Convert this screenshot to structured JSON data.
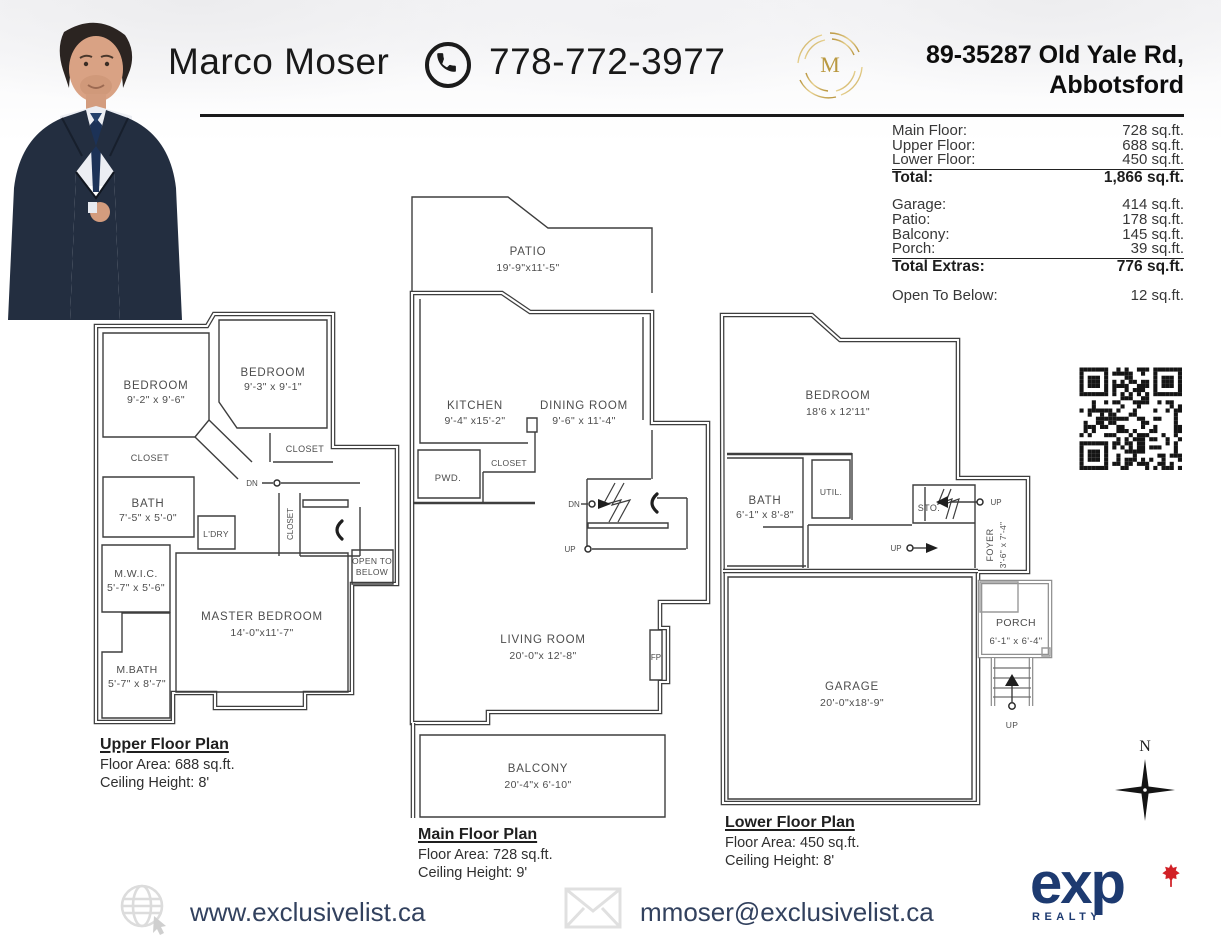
{
  "header": {
    "agent_name": "Marco Moser",
    "phone": "778-772-3977",
    "address_line1": "89-35287 Old Yale Rd,",
    "address_line2": "Abbotsford"
  },
  "area_table": {
    "floor_rows": [
      {
        "label": "Main Floor:",
        "value": "728 sq.ft."
      },
      {
        "label": "Upper Floor:",
        "value": "688 sq.ft."
      },
      {
        "label": "Lower Floor:",
        "value": "450 sq.ft."
      }
    ],
    "total": {
      "label": "Total:",
      "value": "1,866 sq.ft."
    },
    "extra_rows": [
      {
        "label": "Garage:",
        "value": "414 sq.ft."
      },
      {
        "label": "Patio:",
        "value": "178 sq.ft."
      },
      {
        "label": "Balcony:",
        "value": "145 sq.ft."
      },
      {
        "label": "Porch:",
        "value": "39 sq.ft."
      }
    ],
    "total_extras": {
      "label": "Total Extras:",
      "value": "776 sq.ft."
    },
    "open_to_below": {
      "label": "Open To Below:",
      "value": "12 sq.ft."
    }
  },
  "plans": {
    "upper": {
      "title": "Upper Floor Plan",
      "area": "Floor Area: 688 sq.ft.",
      "ceiling": "Ceiling Height: 8'",
      "rooms": {
        "bedroom_left": {
          "name": "BEDROOM",
          "dims": "9'-2\" x 9'-6\""
        },
        "bedroom_right": {
          "name": "BEDROOM",
          "dims": "9'-3\" x 9'-1\""
        },
        "closet_left": "CLOSET",
        "closet_right": "CLOSET",
        "closet_stair": "CLOSET",
        "bath": {
          "name": "BATH",
          "dims": "7'-5\" x 5'-0\""
        },
        "laundry": "L'DRY",
        "dn": "DN",
        "open_below_line1": "OPEN TO",
        "open_below_line2": "BELOW",
        "mwic": {
          "name": "M.W.I.C.",
          "dims": "5'-7\" x 5'-6\""
        },
        "master": {
          "name": "MASTER BEDROOM",
          "dims": "14'-0\"x11'-7\""
        },
        "mbath": {
          "name": "M.BATH",
          "dims": "5'-7\" x 8'-7\""
        }
      }
    },
    "main": {
      "title": "Main Floor Plan",
      "area": "Floor Area: 728 sq.ft.",
      "ceiling": "Ceiling Height: 9'",
      "rooms": {
        "patio": {
          "name": "PATIO",
          "dims": "19'-9\"x11'-5\""
        },
        "kitchen": {
          "name": "KITCHEN",
          "dims": "9'-4\" x15'-2\""
        },
        "dining": {
          "name": "DINING ROOM",
          "dims": "9'-6\" x 11'-4\""
        },
        "powder": "PWD.",
        "closet": "CLOSET",
        "dn": "DN",
        "up": "UP",
        "living": {
          "name": "LIVING ROOM",
          "dims": "20'-0\"x 12'-8\""
        },
        "fireplace": "FP",
        "balcony": {
          "name": "BALCONY",
          "dims": "20'-4\"x 6'-10\""
        }
      }
    },
    "lower": {
      "title": "Lower Floor Plan",
      "area": "Floor Area: 450 sq.ft.",
      "ceiling": "Ceiling Height: 8'",
      "rooms": {
        "bedroom": {
          "name": "BEDROOM",
          "dims": "18'6 x 12'11\""
        },
        "bath": {
          "name": "BATH",
          "dims": "6'-1\" x 8'-8\""
        },
        "util": "UTIL.",
        "storage": "STO.",
        "up_right": "UP",
        "up_mid": "UP",
        "up_stairs": "UP",
        "foyer": {
          "name": "FOYER",
          "dims": "3'-6\" x 7'-4\""
        },
        "garage": {
          "name": "GARAGE",
          "dims": "20'-0\"x18'-9\""
        },
        "porch": {
          "name": "PORCH",
          "dims": "6'-1\" x 6'-4\""
        }
      }
    }
  },
  "footer": {
    "website": "www.exclusivelist.ca",
    "email": "mmoser@exclusivelist.ca",
    "brokerage_name": "exp",
    "brokerage_sub": "REALTY"
  },
  "compass": {
    "north_label": "N"
  }
}
